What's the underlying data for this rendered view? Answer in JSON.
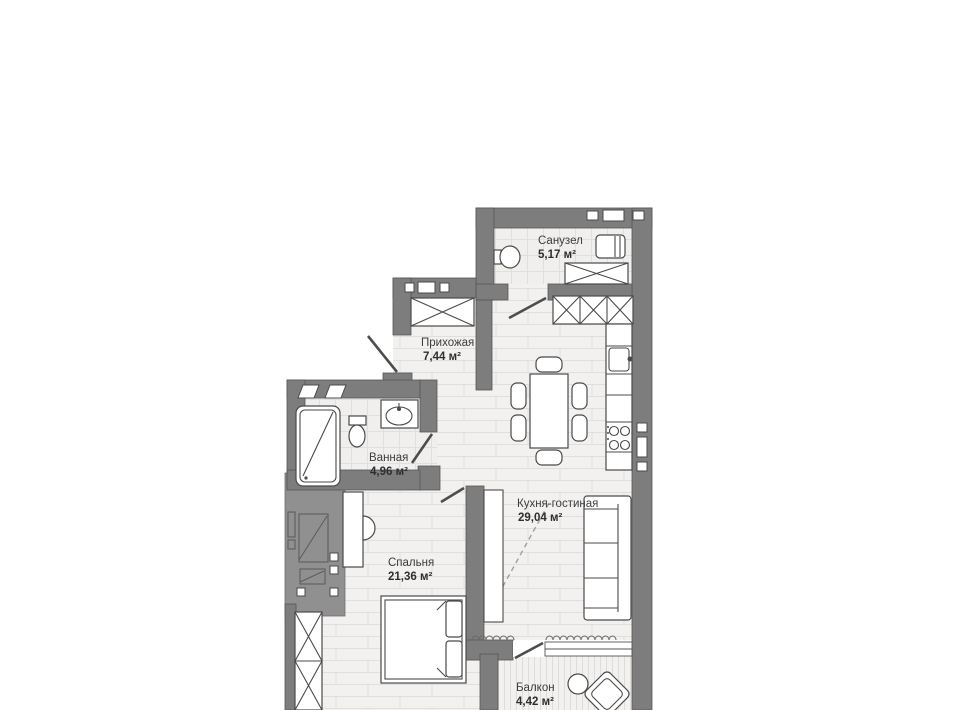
{
  "plan": {
    "rooms": [
      {
        "id": "sanuzel",
        "name": "Санузел",
        "area": "5,17 м²"
      },
      {
        "id": "prihozhaya",
        "name": "Прихожая",
        "area": "7,44 м²"
      },
      {
        "id": "vannaya",
        "name": "Ванная",
        "area": "4,96 м²"
      },
      {
        "id": "kitchen-living",
        "name": "Кухня-гостиная",
        "area": "29,04 м²"
      },
      {
        "id": "spalnya",
        "name": "Спальня",
        "area": "21,36 м²"
      },
      {
        "id": "balkon",
        "name": "Балкон",
        "area": "4,42 м²"
      }
    ],
    "colors": {
      "wall": "#7d7d7d",
      "neighbor_block": "#909090",
      "floor": "#f2f1ef",
      "floor_hatch": "#e1dfdc",
      "furniture_outline": "#4a4a4a",
      "label": "#3d3d3d",
      "background": "#ffffff"
    }
  }
}
